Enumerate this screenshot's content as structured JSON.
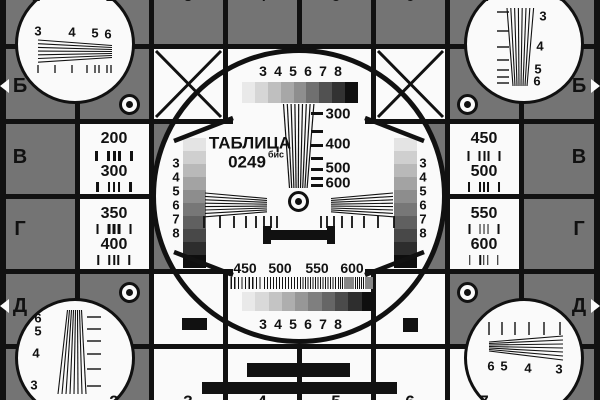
{
  "colors": {
    "background": "#747474",
    "surface": "#fafafa",
    "ink": "#111111"
  },
  "title": {
    "name": "ТАБЛИЦА",
    "number": "0249",
    "suffix": "бис"
  },
  "rows": {
    "left": [
      "Б",
      "В",
      "Г",
      "Д"
    ],
    "right": [
      "Б",
      "В",
      "Г",
      "Д"
    ]
  },
  "columns": {
    "top": [
      "1",
      "2",
      "3",
      "4",
      "5",
      "6",
      "7",
      "8"
    ],
    "bottom": [
      "2",
      "3",
      "4",
      "5",
      "6",
      "7"
    ]
  },
  "scales": {
    "top_labels": [
      "3",
      "4",
      "5",
      "6",
      "7",
      "8"
    ],
    "bottom_labels": [
      "3",
      "4",
      "5",
      "6",
      "7",
      "8"
    ],
    "left_labels": [
      "3",
      "4",
      "5",
      "6",
      "7",
      "8"
    ],
    "right_labels": [
      "3",
      "4",
      "5",
      "6",
      "7",
      "8"
    ],
    "top_steps": [
      "#e9e9e9",
      "#d6d6d6",
      "#bfbfbf",
      "#a7a7a7",
      "#8e8e8e",
      "#707070",
      "#515151",
      "#323232",
      "#101010"
    ],
    "bottom_steps": [
      "#e9e9e9",
      "#d9d9d9",
      "#c4c4c4",
      "#aeaeae",
      "#979797",
      "#7f7f7f",
      "#666666",
      "#4b4b4b",
      "#2e2e2e",
      "#0f0f0f"
    ],
    "left_steps": [
      "#e4e4e4",
      "#cfcfcf",
      "#b9b9b9",
      "#a3a3a3",
      "#8d8d8d",
      "#777777",
      "#606060",
      "#484848",
      "#2d2d2d",
      "#0e0e0e"
    ],
    "right_steps": [
      "#e4e4e4",
      "#cfcfcf",
      "#b9b9b9",
      "#a3a3a3",
      "#8d8d8d",
      "#777777",
      "#606060",
      "#484848",
      "#2d2d2d",
      "#0e0e0e"
    ]
  },
  "tvl": {
    "labels": [
      "300",
      "400",
      "500",
      "600"
    ]
  },
  "freq": {
    "labels": [
      "450",
      "500",
      "550",
      "600"
    ]
  },
  "cells": {
    "left": [
      [
        "200",
        "300"
      ],
      [
        "350",
        "400"
      ]
    ],
    "right": [
      [
        "450",
        "500"
      ],
      [
        "550",
        "600"
      ]
    ]
  },
  "wedges": {
    "top_left": [
      "3",
      "4",
      "5",
      "6"
    ],
    "top_right": [
      "3",
      "4",
      "5",
      "6"
    ],
    "bottom_left": [
      "6",
      "5",
      "4",
      "3"
    ],
    "bottom_right": [
      "6",
      "5",
      "4",
      "3"
    ]
  }
}
